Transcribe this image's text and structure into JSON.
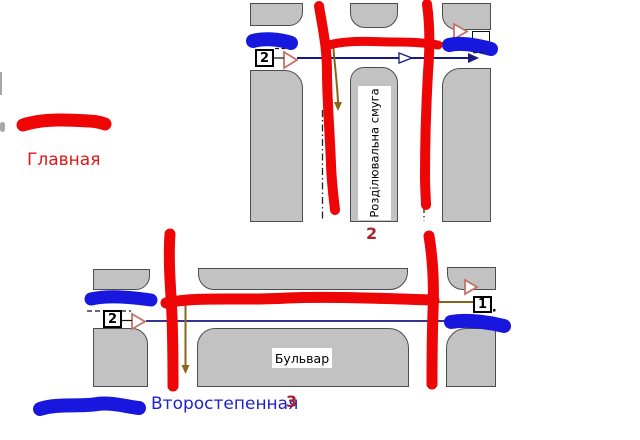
{
  "legend": {
    "main_label": "Главная",
    "secondary_label": "Второстепенная",
    "main_color": "#e41414",
    "secondary_color": "#1e1ed2"
  },
  "top_intersection": {
    "figure_number": "2",
    "median_label": "Розділювальна смуга",
    "left_badge": "2"
  },
  "bottom_intersection": {
    "figure_number": "3",
    "boulevard_label": "Бульвар",
    "left_badge": "2",
    "right_badge": "1"
  },
  "colors": {
    "main_road_marker": "#ee0505",
    "secondary_road_marker": "#1717dd",
    "route_line": "#181880",
    "sign_pointer_line": "#8a6418",
    "road_fill": "#c2c2c2",
    "figure_number_color": "#a8232e"
  }
}
